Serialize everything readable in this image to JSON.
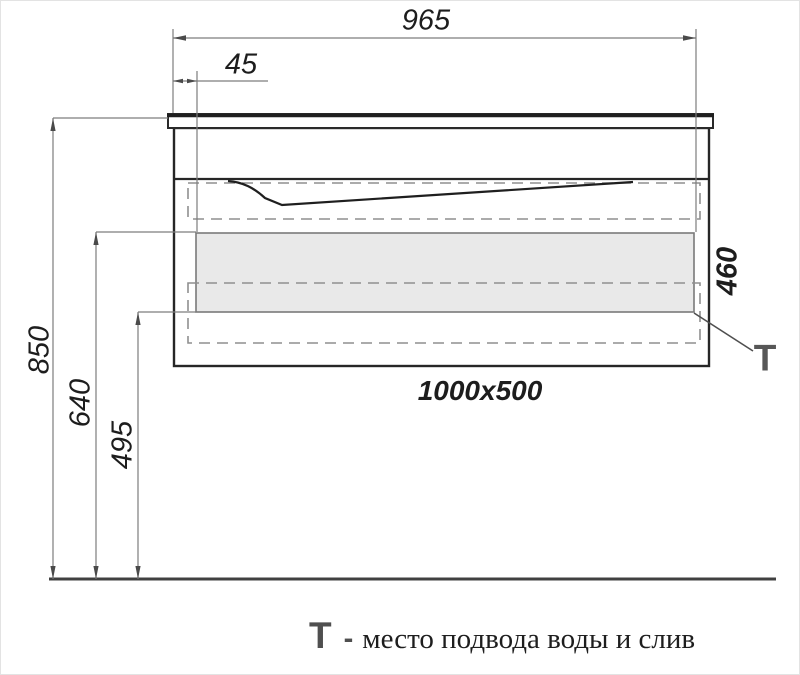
{
  "figure": {
    "type": "technical-drawing",
    "product_size_label": "1000x500",
    "dimensions": {
      "top_width": "965",
      "left_offset": "45",
      "height_total": "850",
      "height_to_panel_top": "640",
      "height_to_panel_bottom": "495",
      "cabinet_height": "460"
    },
    "t_marker": "Т",
    "legend": {
      "marker": "Т",
      "separator": "-",
      "text": "место подвода воды и слив"
    },
    "colors": {
      "outline": "#262626",
      "thin_line": "#7d7d7d",
      "dashed_line": "#8f8f8f",
      "panel_fill": "#e9e9e9",
      "floor_line": "#404040",
      "marker_gray": "#575757"
    }
  }
}
